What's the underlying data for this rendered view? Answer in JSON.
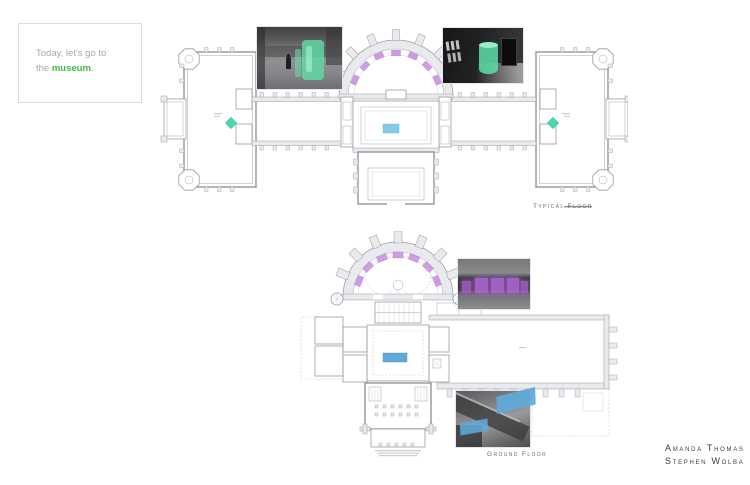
{
  "intro_card": {
    "line1": "Today, let's go to",
    "line2_before": "the ",
    "line2_highlight": "museum",
    "line2_after": "."
  },
  "plans": {
    "typical_floor": {
      "label": "Typical Floor"
    },
    "ground_floor": {
      "label": "Ground Floor"
    }
  },
  "credits": {
    "authors": [
      "Amanda Thomas",
      "Stephen Wolba"
    ]
  },
  "colors": {
    "hl-green": "#4ad9a2",
    "hl-purple": "#cf9ae4",
    "hl-cyan": "#85cbe8",
    "hl-blue": "#5fa9d9",
    "accent-green": "#43b649",
    "plan-line": "#979da3",
    "plan-line-light": "#c3c8cc",
    "plan-fill": "#e8eaed",
    "text-gray": "#a8a8a8",
    "text-dark": "#3c3c3c"
  }
}
